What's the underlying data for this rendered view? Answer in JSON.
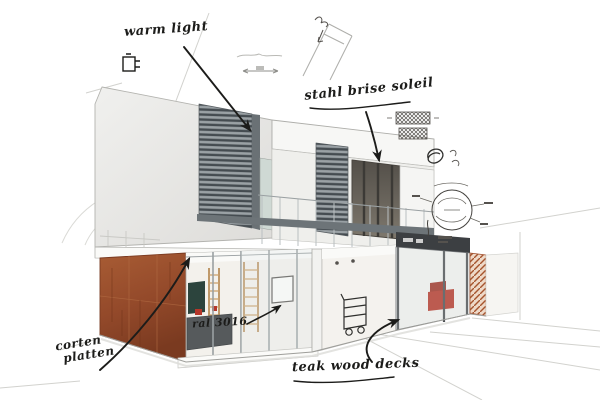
{
  "scene": {
    "type": "architectural concept sketch",
    "subject": "modern two-storey house, corten steel base, louvered upper facade, handwritten design notes"
  },
  "annotations": {
    "warm_light": {
      "label": "warm light"
    },
    "brise_soleil": {
      "label": "stahl brise soleil"
    },
    "corten": {
      "line1": "corten",
      "line2": "platten"
    },
    "ral": {
      "label": "ral 3016"
    },
    "decking": {
      "label": "teak wood decks"
    }
  },
  "colors": {
    "ink": "#1c1c1a",
    "pencil": "#c7c7c3",
    "corten_rust": "#9c4f2c",
    "louver_gray": "#4e555a",
    "glass_tint": "#dfe7e8",
    "red_accent": "#b5372a"
  }
}
